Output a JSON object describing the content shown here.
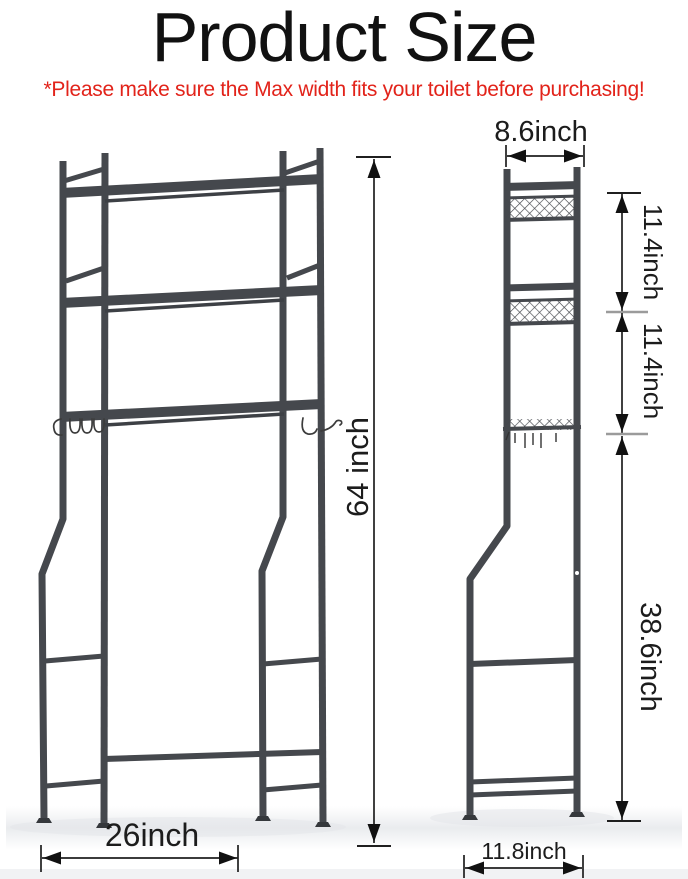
{
  "header": {
    "title": "Product Size",
    "subtitle": "*Please make sure the Max width fits your toilet before purchasing!"
  },
  "colors": {
    "title_text": "#111111",
    "warning_red": "#e2231a",
    "rack_gray": "#45484d",
    "dimension_lines": "#1f1f1f",
    "junction_tick_gray": "#9b9b9b",
    "background": "#ffffff"
  },
  "front_view": {
    "description": "front view of over-the-toilet storage rack, 3 shelves, hooks, flared back legs",
    "height": {
      "label": "64 inch"
    },
    "width": {
      "label": "26inch"
    }
  },
  "side_view": {
    "description": "side view of rack with wire basket shelves",
    "top_width": {
      "label": "8.6inch"
    },
    "tier1_gap": {
      "label": "11.4inch"
    },
    "tier2_gap": {
      "label": "11.4inch"
    },
    "lower_height": {
      "label": "38.6inch"
    },
    "base_depth": {
      "label": "11.8inch"
    }
  }
}
